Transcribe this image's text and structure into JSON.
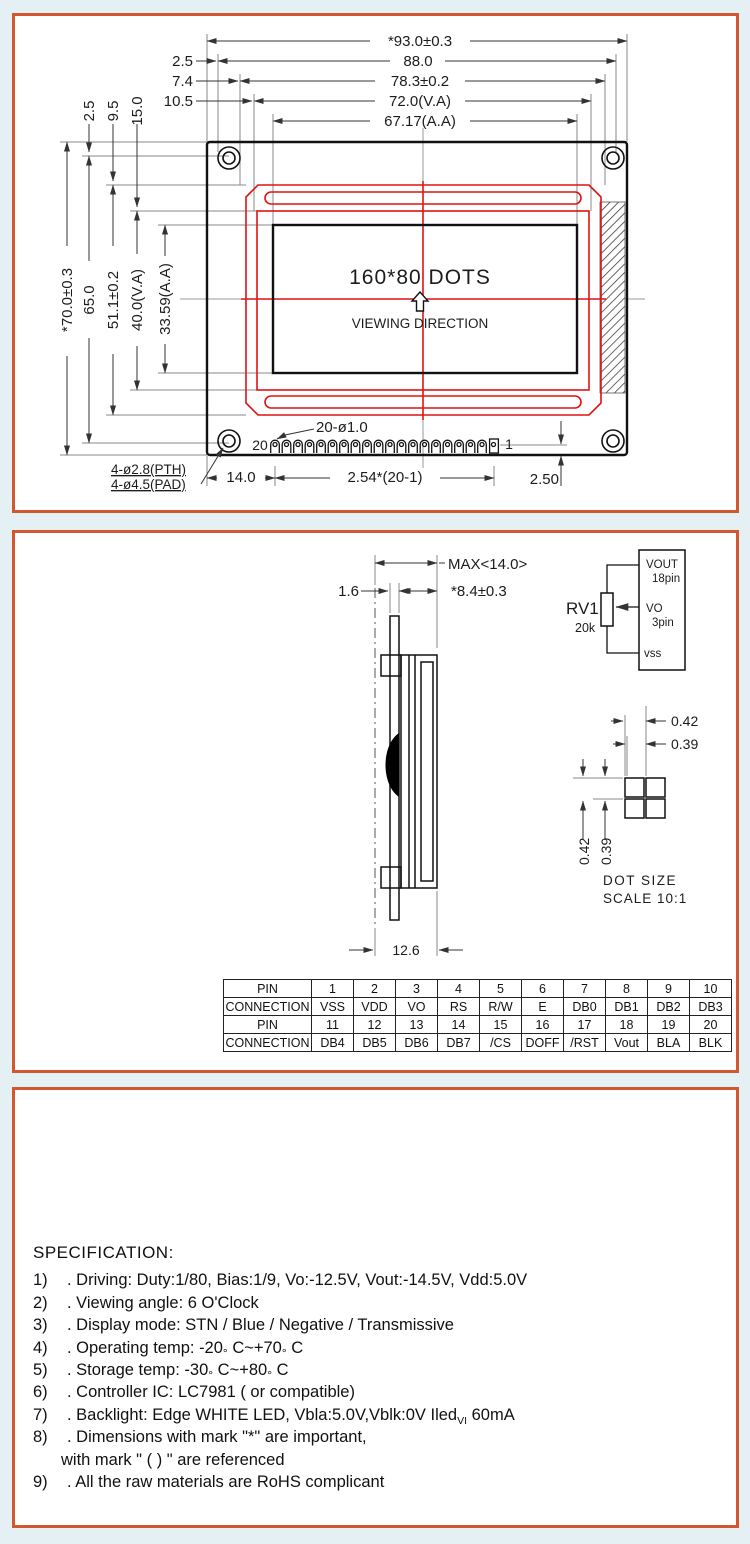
{
  "panel1": {
    "dims_top": [
      "*93.0±0.3",
      "88.0",
      "78.3±0.2",
      "72.0(V.A)",
      "67.17(A.A)"
    ],
    "offsets_h": [
      "2.5",
      "7.4",
      "10.5"
    ],
    "offsets_v": [
      "2.5",
      "9.5",
      "15.0"
    ],
    "dims_left": [
      "*70.0±0.3",
      "65.0",
      "51.1±0.2",
      "40.0(V.A)",
      "33.59(A.A)"
    ],
    "display_label": "160*80 DOTS",
    "viewing_direction": "VIEWING DIRECTION",
    "pin_first": "20",
    "pin_last": "1",
    "pin_note": "20-ø1.0",
    "hole_note_pth": "4-ø2.8(PTH)",
    "hole_note_pad": "4-ø4.5(PAD)",
    "dim_margin": "14.0",
    "dim_pitch": "2.54*(20-1)",
    "dim_edge": "2.50"
  },
  "panel2": {
    "dim_max": "MAX<14.0>",
    "dim_pcb": "1.6",
    "dim_height": "*8.4±0.3",
    "dim_width": "12.6",
    "rv1": {
      "label": "RV1",
      "value": "20k",
      "pin_top": "VOUT",
      "pin_top2": "18pin",
      "pin_mid": "VO",
      "pin_mid2": "3pin",
      "pin_bot": "vss"
    },
    "dot": {
      "h1": "0.42",
      "h2": "0.39",
      "v1": "0.42",
      "v2": "0.39",
      "caption1": "DOT SIZE",
      "caption2": "SCALE 10:1"
    },
    "table": {
      "rows": [
        [
          "PIN",
          "1",
          "2",
          "3",
          "4",
          "5",
          "6",
          "7",
          "8",
          "9",
          "10"
        ],
        [
          "CONNECTION",
          "VSS",
          "VDD",
          "VO",
          "RS",
          "R/W",
          "E",
          "DB0",
          "DB1",
          "DB2",
          "DB3"
        ],
        [
          "PIN",
          "11",
          "12",
          "13",
          "14",
          "15",
          "16",
          "17",
          "18",
          "19",
          "20"
        ],
        [
          "CONNECTION",
          "DB4",
          "DB5",
          "DB6",
          "DB7",
          "/CS",
          "DOFF",
          "/RST",
          "Vout",
          "BLA",
          "BLK"
        ]
      ]
    }
  },
  "panel3": {
    "title": "SPECIFICATION:",
    "items": [
      {
        "num": "1)",
        "text": ". Driving: Duty:1/80, Bias:1/9, Vo:-12.5V, Vout:-14.5V, Vdd:5.0V"
      },
      {
        "num": "2)",
        "text": ". Viewing angle: 6 O'Clock"
      },
      {
        "num": "3)",
        "text": ". Display mode: STN / Blue / Negative / Transmissive"
      },
      {
        "num": "4)",
        "pre": ". Operating temp: -20",
        "deg1": "°",
        "mid": " C~+70",
        "deg2": "°",
        "post": " C"
      },
      {
        "num": "5)",
        "pre": ". Storage temp:  -30",
        "deg1": "°",
        "mid": " C~+80",
        "deg2": "°",
        "post": " C"
      },
      {
        "num": "6)",
        "text": ". Controller IC: LC7981  ( or compatible)"
      },
      {
        "num": "7)",
        "pre": ". Backlight: Edge  WHITE LED, Vbla:5.0V,Vblk:0V Iled",
        "sub": "VI",
        "post": " 60mA"
      },
      {
        "num": "8)",
        "text": ". Dimensions with mark \"*\" are important,"
      },
      {
        "num": "",
        "text": "with mark \" ( )  \" are referenced"
      },
      {
        "num": "9)",
        "text": ". All the raw materials are RoHS complicant"
      }
    ]
  }
}
